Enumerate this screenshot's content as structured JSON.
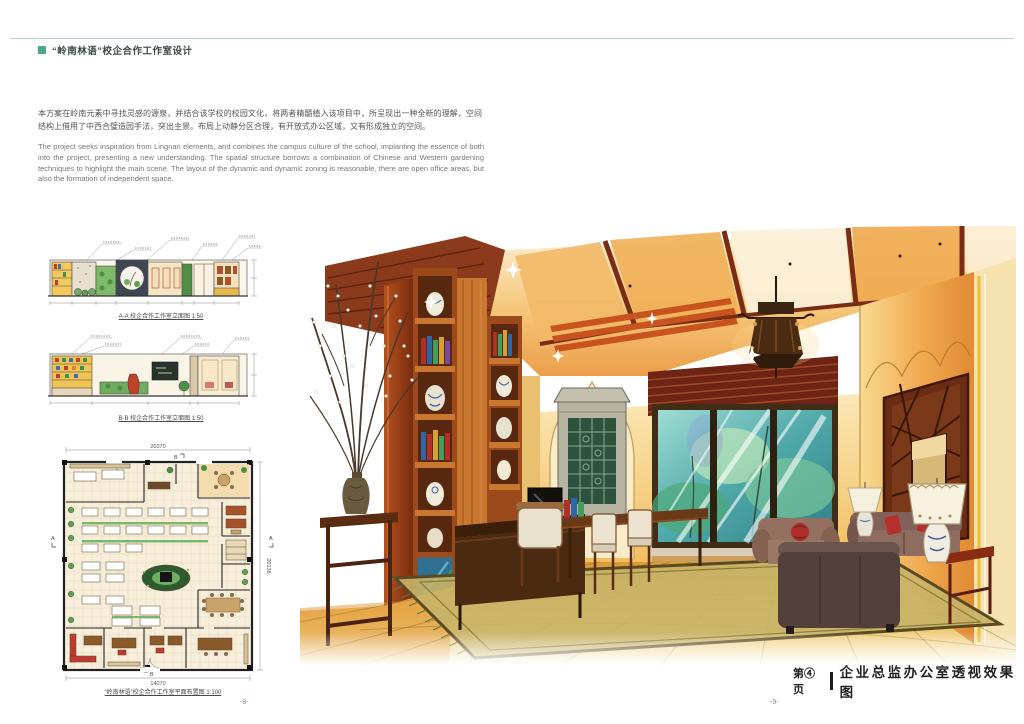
{
  "header": {
    "title": "“岭南林语”校企合作工作室设计"
  },
  "intro": {
    "zh": "本方案在岭南元素中寻找灵感的源泉，并结合该学校的校园文化，将两者精髓植入该项目中，所呈现出一种全新的理解，空间结构上借用了中西合璧造园手法，突出主景。布局上动静分区合理，有开放式办公区域，又有形成独立的空间。",
    "en": "The project seeks inspiration from Lingnan elements, and combines the campus culture of the school, implanting the essence of both into the project, presenting a new understanding. The spatial structure borrows a combination of Chinese and Western gardening techniques to highlight the main scene. The layout of the dynamic and dynamic zoning is reasonable, there are open office areas, but also the formation of independent space."
  },
  "drawings": {
    "elevation_a": {
      "caption": "A-A 校企合作工作室立面图 1:50"
    },
    "elevation_b": {
      "caption": "B-B 校企合作工作室立面图 1:50"
    },
    "plan": {
      "caption": "“岭南林语”校企合作工作室平面布置图 1:100",
      "dim_top": "20370",
      "dim_right": "20138",
      "dim_bottom": "14070",
      "marker_a": "A",
      "marker_b": "B"
    }
  },
  "rendering": {
    "page_label": "第④页",
    "title": "企业总监办公室透视效果图"
  },
  "footer": {
    "page_left": "-8-",
    "page_right": "-9-"
  },
  "palette": {
    "accent_teal": "#4aa98b",
    "rule_line": "#b7d2c6",
    "heading_text": "#3a4a44",
    "body_text": "#555555",
    "body_text_light": "#777777",
    "page_number": "#7a948c",
    "ink": "#1f1f1f",
    "wood_dark": "#7a2c14",
    "wood_orange": "#c9762e",
    "wall_warm": "#f2c060",
    "window_teal": "#4fa8a8",
    "floor_gold": "#e8b84b"
  }
}
